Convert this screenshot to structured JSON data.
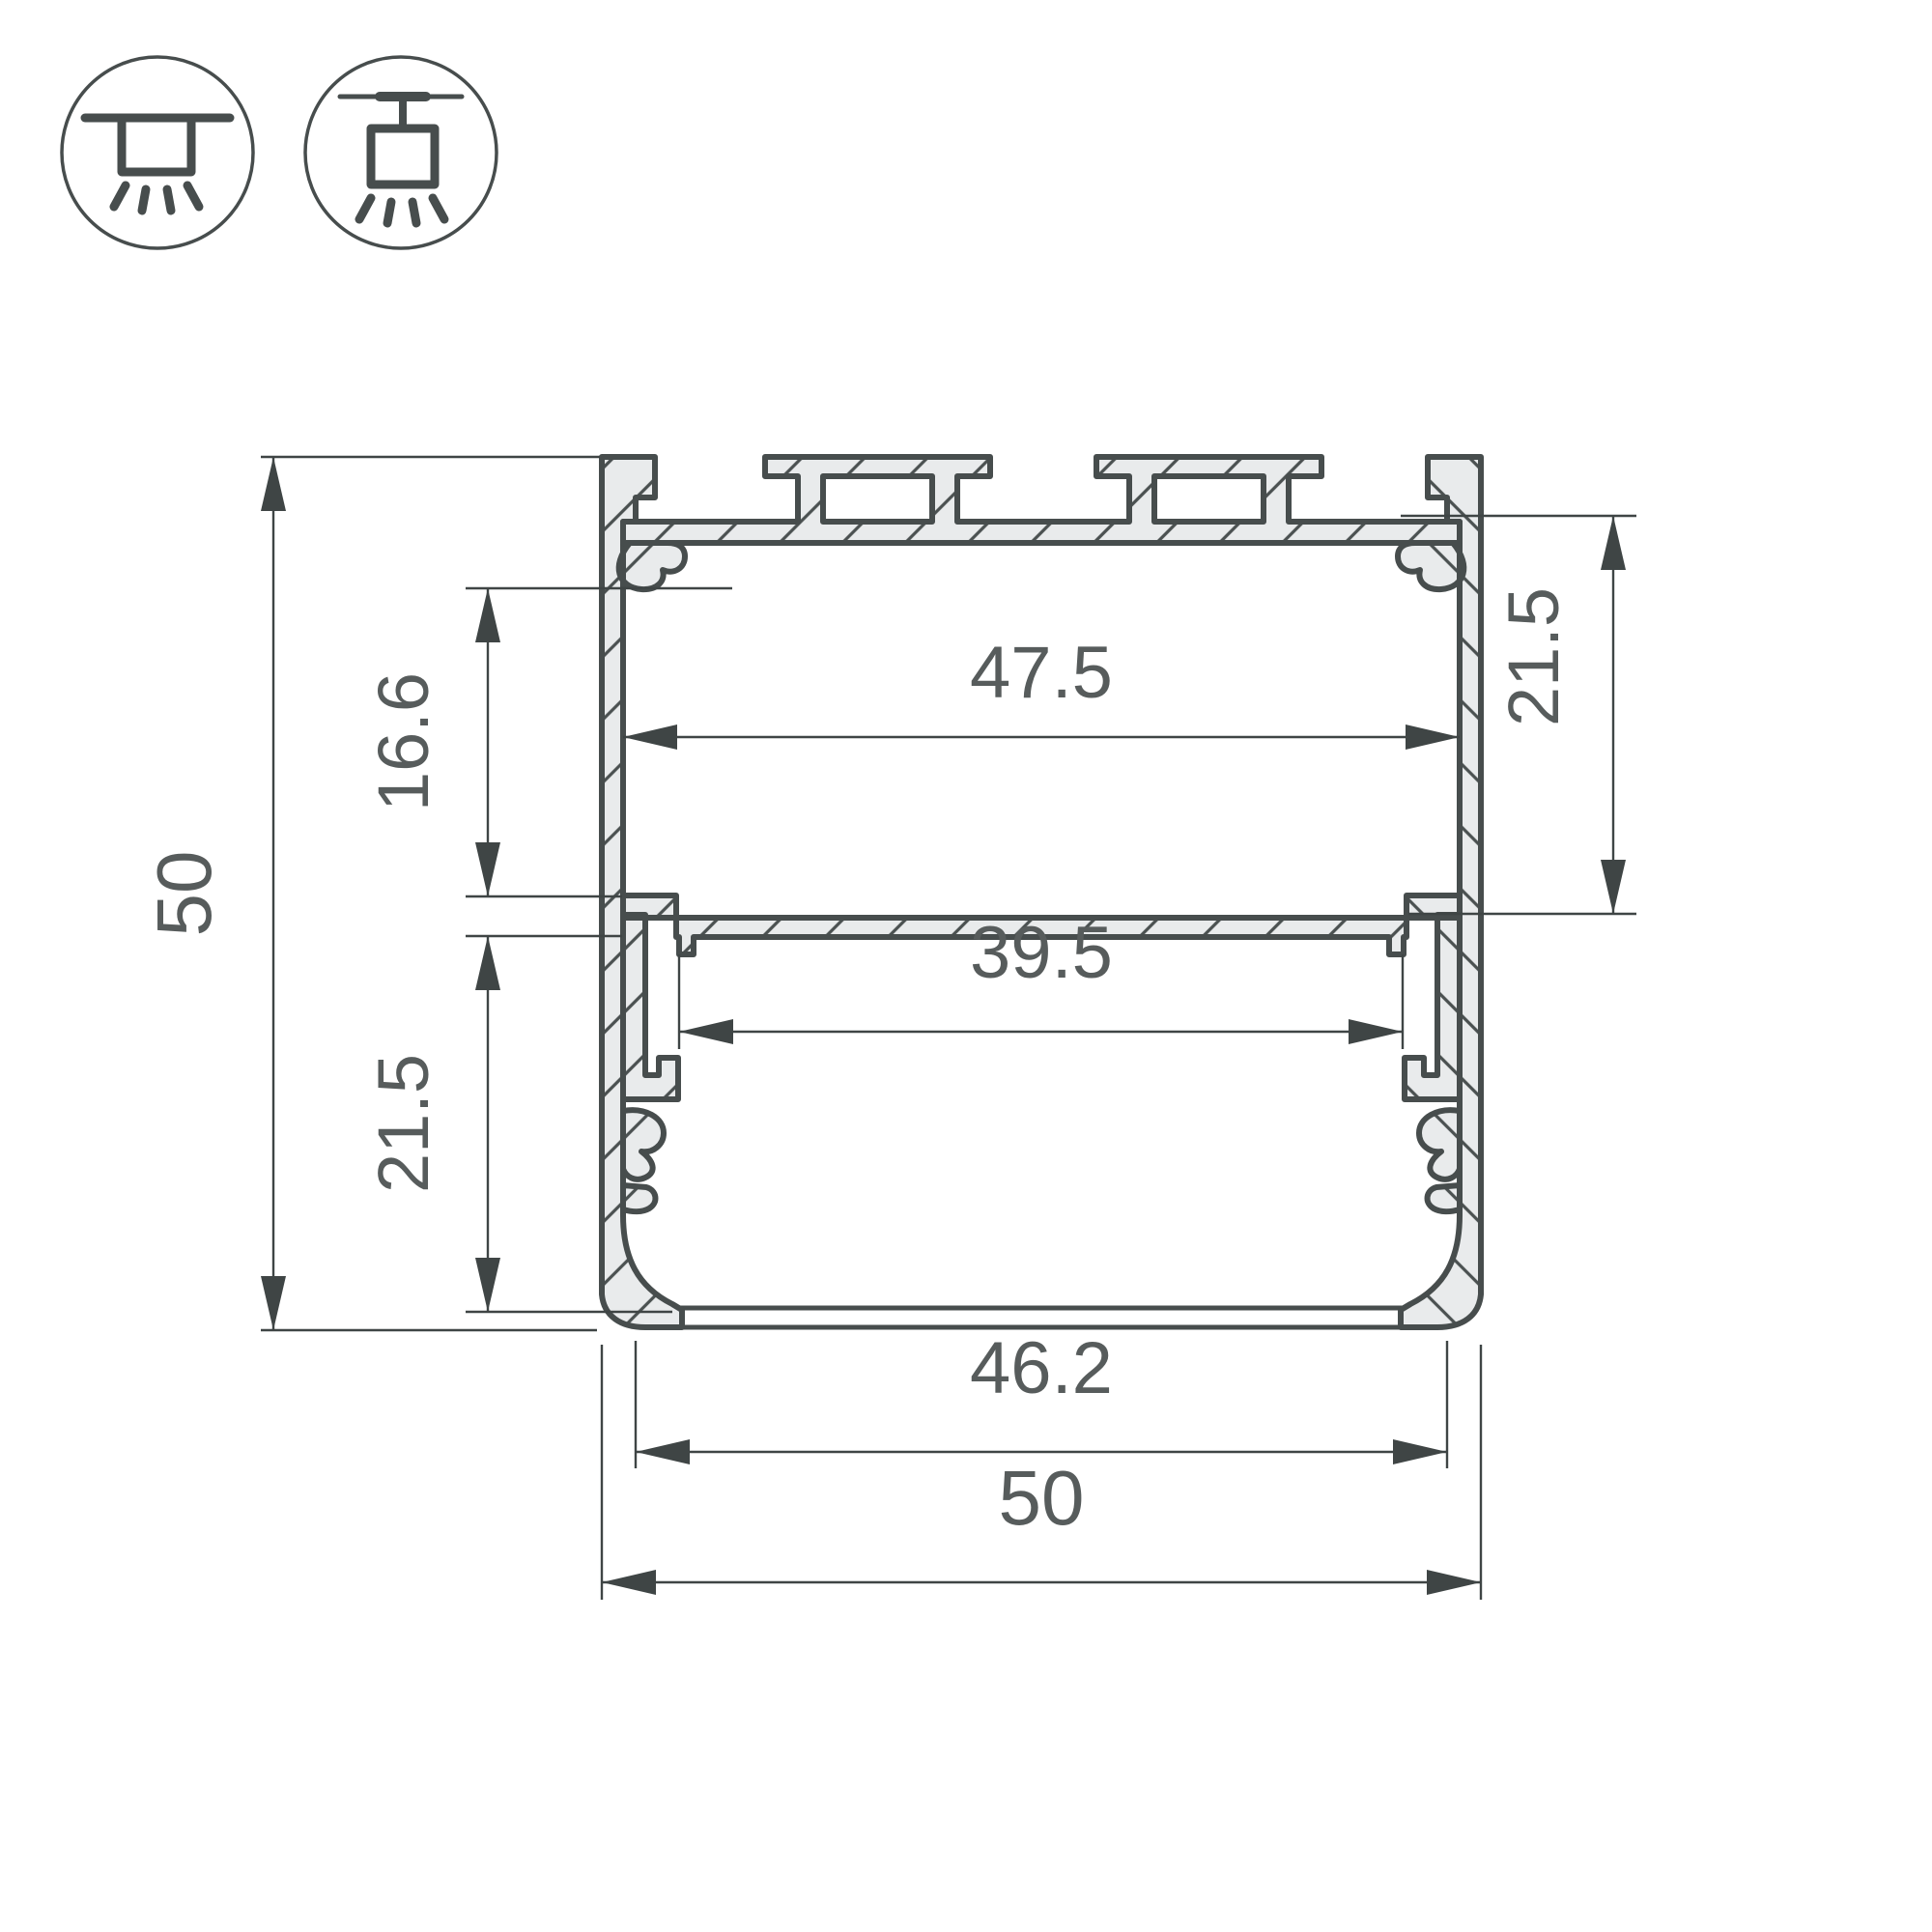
{
  "drawing": {
    "title": "LED profile cross-section technical drawing",
    "units": "mm",
    "dimensions": {
      "overall_height": {
        "label": "50",
        "value": 50,
        "orientation": "vertical",
        "side": "left"
      },
      "upper_chamber_height": {
        "label": "16.6",
        "value": 16.6,
        "orientation": "vertical",
        "side": "left"
      },
      "lower_chamber_height": {
        "label": "21.5",
        "value": 21.5,
        "orientation": "vertical",
        "side": "left"
      },
      "upper_inner_width": {
        "label": "47.5",
        "value": 47.5,
        "orientation": "horizontal",
        "side": "middle-upper"
      },
      "shelf_opening_width": {
        "label": "39.5",
        "value": 39.5,
        "orientation": "horizontal",
        "side": "middle-lower"
      },
      "right_chamber_height": {
        "label": "21.5",
        "value": 21.5,
        "orientation": "vertical",
        "side": "right"
      },
      "bottom_opening_width": {
        "label": "46.2",
        "value": 46.2,
        "orientation": "horizontal",
        "side": "bottom"
      },
      "overall_width": {
        "label": "50",
        "value": 50,
        "orientation": "horizontal",
        "side": "bottom"
      }
    },
    "icons": [
      {
        "name": "ceiling-surface-mount-icon"
      },
      {
        "name": "ceiling-pendant-mount-icon"
      }
    ],
    "colors": {
      "outline": "#474d4d",
      "metal_fill": "#e9ebec",
      "hatch": "#4b5151",
      "dimension_line": "#3f4545",
      "dimension_text": "#575c5c",
      "background": "#ffffff"
    }
  }
}
